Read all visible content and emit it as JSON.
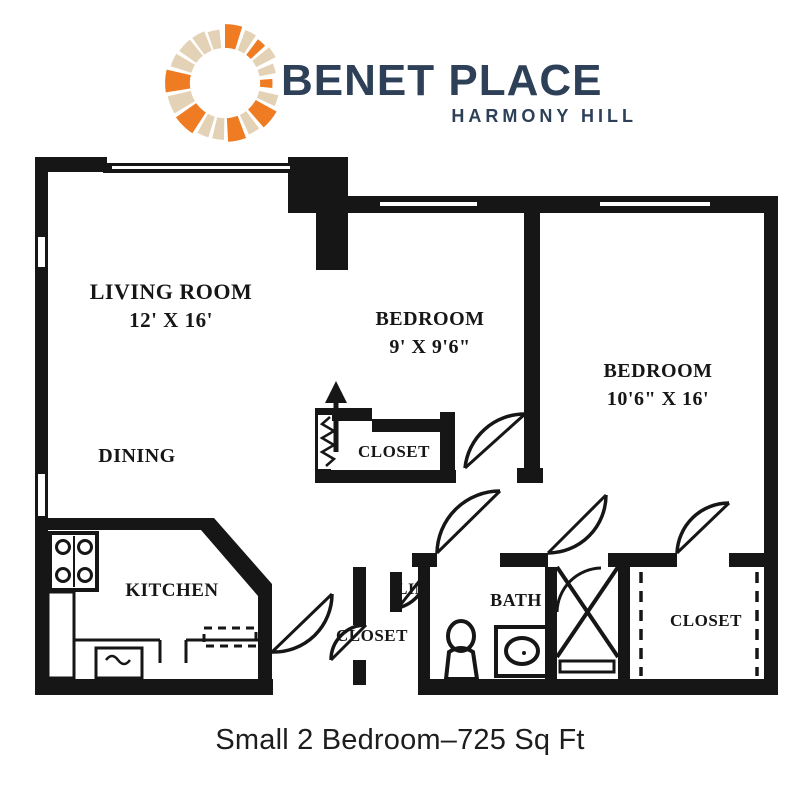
{
  "logo": {
    "brand": "BENET PLACE",
    "tagline": "HARMONY HILL",
    "icon": "sunburst-ring-icon",
    "colors": {
      "orange": "#EF7C23",
      "tan": "#E4D2B6",
      "navy": "#2E4057"
    },
    "segments": [
      [
        -90,
        -73,
        "orange",
        57
      ],
      [
        -69,
        -57,
        "tan",
        55
      ],
      [
        -53,
        -43,
        "orange",
        53
      ],
      [
        -39,
        -27,
        "tan",
        55
      ],
      [
        -22,
        -11,
        "tan",
        50
      ],
      [
        -5,
        6,
        "orange",
        46
      ],
      [
        13,
        25,
        "tan",
        53
      ],
      [
        29,
        49,
        "orange",
        57
      ],
      [
        53,
        65,
        "tan",
        55
      ],
      [
        69,
        87,
        "orange",
        57
      ],
      [
        91,
        103,
        "tan",
        55
      ],
      [
        107,
        119,
        "tan",
        55
      ],
      [
        123,
        145,
        "orange",
        58
      ],
      [
        149,
        167,
        "tan",
        57
      ],
      [
        171,
        193,
        "orange",
        58
      ],
      [
        197,
        211,
        "tan",
        55
      ],
      [
        215,
        231,
        "tan",
        54
      ],
      [
        234,
        248,
        "tan",
        54
      ],
      [
        251,
        264,
        "tan",
        52
      ]
    ]
  },
  "floor_plan": {
    "ink_color": "#161616",
    "rooms": {
      "living_room": {
        "name": "LIVING ROOM",
        "dims": "12' X 16'"
      },
      "dining": {
        "name": "DINING"
      },
      "bedroom_1": {
        "name": "BEDROOM",
        "dims": "9' X 9'6\""
      },
      "bedroom_2": {
        "name": "BEDROOM",
        "dims": "10'6\" X 16'"
      },
      "bedroom_1_closet": {
        "name": "CLOSET"
      },
      "kitchen": {
        "name": "KITCHEN"
      },
      "linen": {
        "name": "LIN."
      },
      "bath": {
        "name": "BATH"
      },
      "hall_closet": {
        "name": "CLOSET"
      },
      "bedroom_2_closet": {
        "name": "CLOSET"
      }
    }
  },
  "caption": {
    "text": "Small 2 Bedroom–725 Sq Ft"
  }
}
